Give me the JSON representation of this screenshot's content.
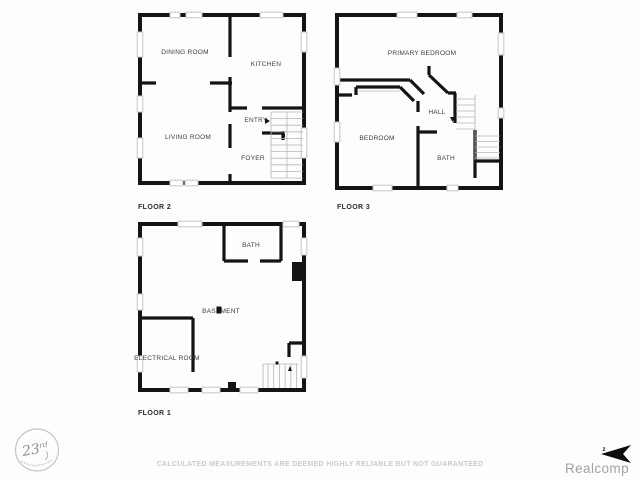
{
  "floors": {
    "floor2": {
      "label": "FLOOR 2",
      "rooms": {
        "dining": "DINING ROOM",
        "kitchen": "KITCHEN",
        "living": "LIVING ROOM",
        "entry": "ENTRY",
        "foyer": "FOYER"
      }
    },
    "floor3": {
      "label": "FLOOR 3",
      "rooms": {
        "primary": "PRIMARY BEDROOM",
        "hall": "HALL",
        "bedroom": "BEDROOM",
        "bath": "BATH"
      }
    },
    "floor1": {
      "label": "FLOOR 1",
      "rooms": {
        "bath": "BATH",
        "basement": "BASEMENT",
        "electrical": "ELECTRICAL ROOM"
      }
    }
  },
  "footer": {
    "disclaimer": "CALCULATED MEASUREMENTS ARE DEEMED HIGHLY RELIABLE BUT NOT GUARANTEED",
    "brand": "Realcomp",
    "brand_mark": "z"
  },
  "stamp": {
    "number": "23",
    "suffix": "rd"
  },
  "colors": {
    "background": "#fdfdfd",
    "wall": "#141414",
    "window": "#c6c6c6",
    "stair": "#b5b5b5",
    "room_label": "#3d3d3d",
    "floor_label": "#2b2b2b",
    "disclaimer": "#cbcbcb",
    "brand": "#a2a2a2",
    "stamp": "#919191"
  }
}
